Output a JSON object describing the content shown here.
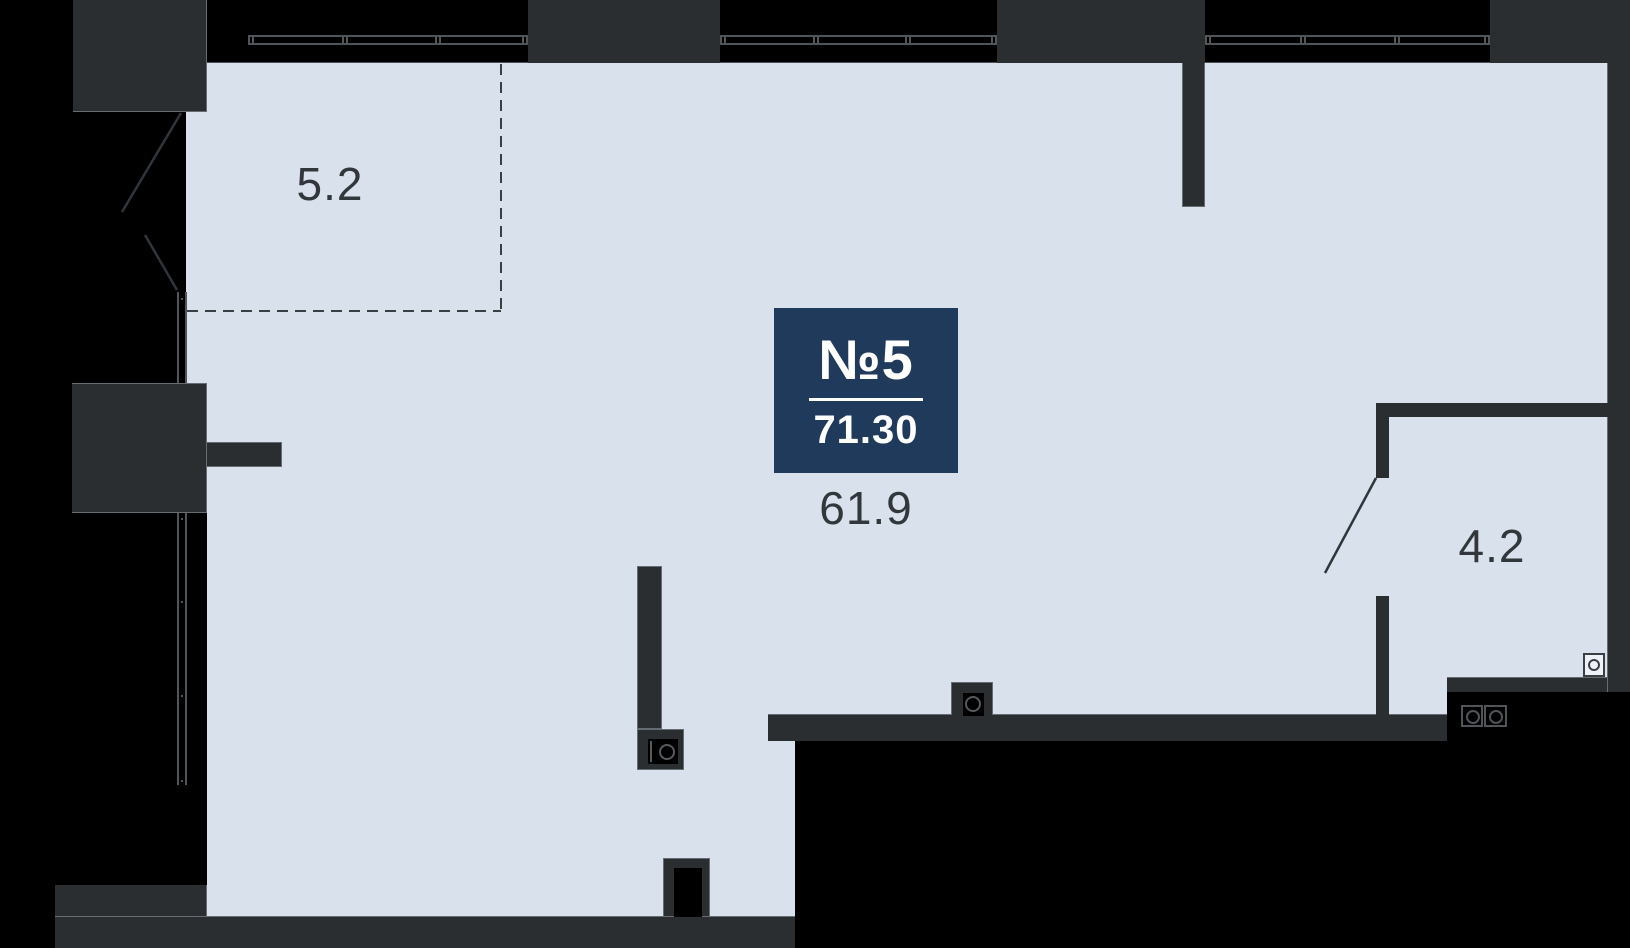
{
  "meta": {
    "type": "apartment-floor-plan"
  },
  "colors": {
    "background": "#000000",
    "floor": "#d8e1ec",
    "structure_gray": "#2b2e31",
    "badge_navy": "#203a5c",
    "line_gray": "#50555a",
    "label_text": "#32373c",
    "badge_text": "#ffffff",
    "edge_light": "rgba(174,184,196,0.45)",
    "washer_fill": "#eef2f8"
  },
  "badge": {
    "number": "№5",
    "total_area": "71.30"
  },
  "rooms": [
    {
      "name": "main-room",
      "area": "61.9"
    },
    {
      "name": "balcony",
      "area": "5.2"
    },
    {
      "name": "bathroom",
      "area": "4.2"
    }
  ],
  "icons": [
    "window-icon",
    "door-swing-icon",
    "balcony-dashed-outline-icon",
    "boiler-icon",
    "sink-icon",
    "washing-machine-icon",
    "stove-burners-icon",
    "shaft-niche-icon"
  ]
}
